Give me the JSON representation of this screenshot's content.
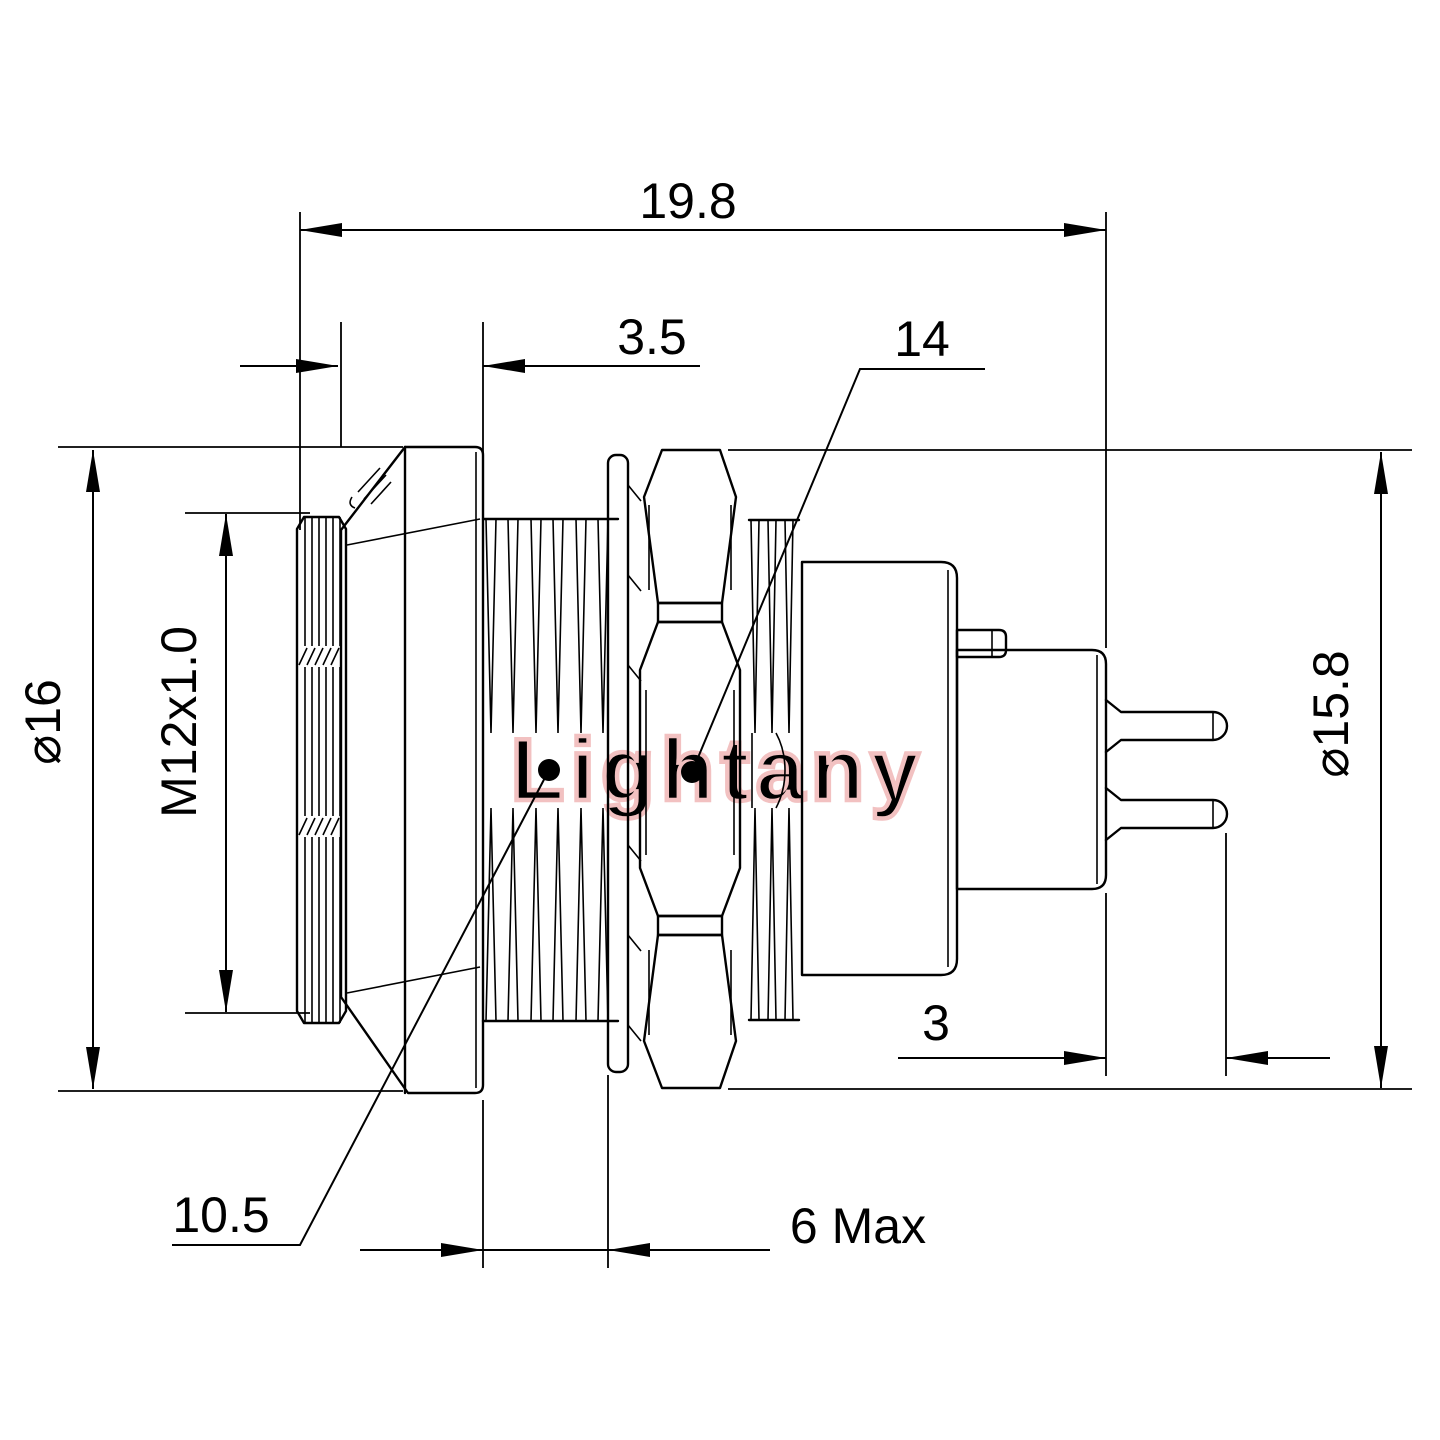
{
  "drawing": {
    "type": "connector-dimension-drawing",
    "background": "#ffffff",
    "line_color": "#000000"
  },
  "watermark": {
    "text": "Lightany",
    "color": "#f2c1c1"
  },
  "dimensions": {
    "overall_length": "19.8",
    "flange_thickness": "3.5",
    "nut_across_flats": "14",
    "flange_diameter": "⌀16",
    "thread_spec": "M12x1.0",
    "nut_across_corners": "⌀15.8",
    "pin_tail_length": "3",
    "thread_minor_diameter": "10.5",
    "panel_max_thickness": "6 Max"
  }
}
